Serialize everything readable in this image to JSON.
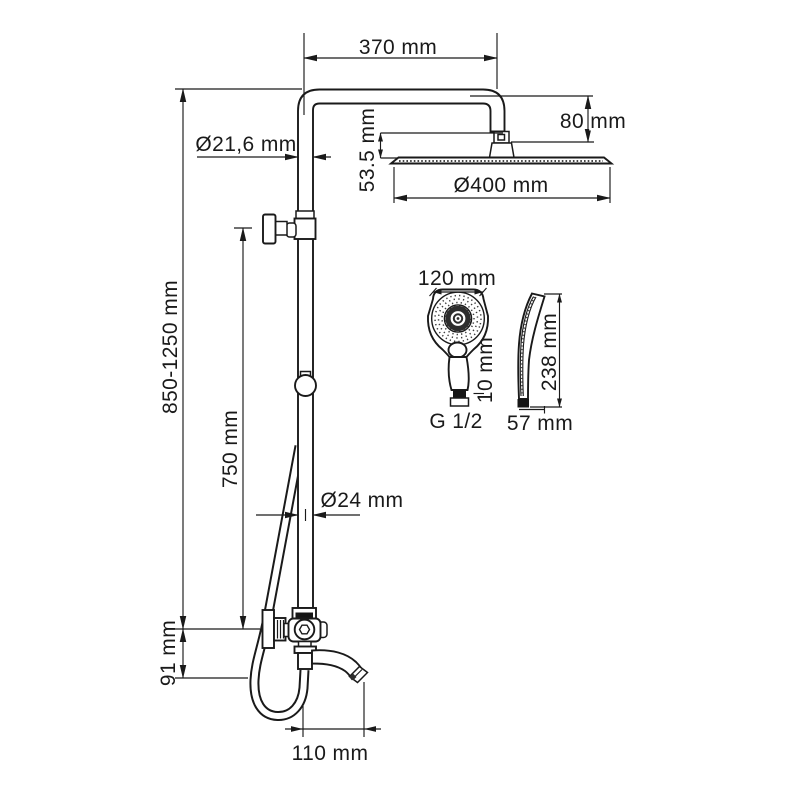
{
  "diagram": {
    "type": "technical-dimension-drawing",
    "subject": "shower-column-system-with-rain-head-hand-shower-and-spout",
    "units": "mm",
    "colors": {
      "line": "#1a1a1a",
      "background": "#ffffff",
      "fill_dark": "#151515"
    },
    "dimensions": {
      "arm_length": "370 mm",
      "head_drop": "80 mm",
      "pipe_diameter_top": "Ø21,6 mm",
      "head_height": "53.5 mm",
      "head_diameter": "Ø400 mm",
      "column_height": "850-1250 mm",
      "upper_section_length": "750 mm",
      "handshower_width": "120 mm",
      "handshower_thread_length": "10 mm",
      "handshower_connection": "G 1/2",
      "handshower_length": "238 mm",
      "handshower_depth": "57 mm",
      "pipe_diameter_bottom": "Ø24 mm",
      "mixer_height": "91 mm",
      "spout_reach": "110 mm"
    }
  }
}
